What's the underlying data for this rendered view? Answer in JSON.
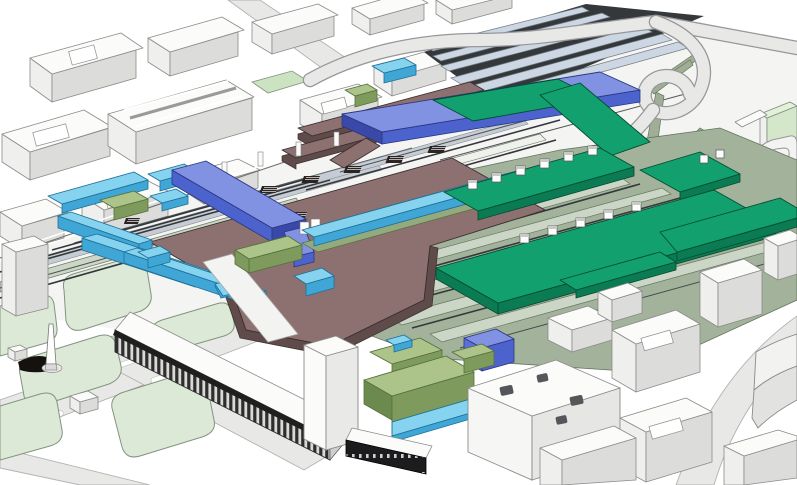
{
  "scene": {
    "kind": "3d-axonometric-railway-station-masterplan",
    "elements": [
      {
        "name": "context-city-blocks",
        "color_key": "block_top"
      },
      {
        "name": "railway-tracks",
        "color_key": "track_dark"
      },
      {
        "name": "north-platforms",
        "color_key": "platform_pale"
      },
      {
        "name": "south-platform-yard",
        "color_key": "platform_sage"
      },
      {
        "name": "concourse-deck",
        "color_key": "mauve_top"
      },
      {
        "name": "green-roof-deck",
        "color_key": "emerald_top"
      },
      {
        "name": "pedestrian-bridges",
        "color_key": "blue_top"
      },
      {
        "name": "secondary-walkways",
        "color_key": "cyan_top"
      },
      {
        "name": "pavilion-buildings",
        "color_key": "olive_top"
      },
      {
        "name": "historic-station-building",
        "color_key": "block_top"
      },
      {
        "name": "park",
        "color_key": "lawn"
      },
      {
        "name": "elevated-road",
        "color_key": "road_fill"
      }
    ]
  },
  "palette": {
    "paper": "#ffffff",
    "corridor": "#f4f4f3",
    "road_fill": "#e8e8e7",
    "road_edge": "#b2b2b0",
    "block_top": "#fbfbfa",
    "block_side_light": "#efefed",
    "block_side_dark": "#dcdcda",
    "block_stroke": "#8b8b89",
    "lawn": "#dce9d7",
    "lawn_stroke": "#83937f",
    "green_field": "#cbe3c0",
    "track_dark": "#34383b",
    "platform_pale": "#ccd7e3",
    "plat_stroke": "#707a84",
    "platform_sage": "#a2b29b",
    "platform_sage_light": "#cbd6c6",
    "sage_stroke": "#66755f",
    "wedge": "#9fae95",
    "emerald_top": "#12a16e",
    "emerald_side": "#0a7b52",
    "emerald_stroke": "#064a31",
    "blue_top": "#8292e3",
    "blue_side": "#4c63ce",
    "blue_deep": "#3a49a8",
    "blue_dark": "#2b3780",
    "cyan_top": "#85d3ef",
    "cyan_side": "#3fa6d6",
    "cyan_dark": "#1f6f96",
    "olive_top": "#acc389",
    "olive_side": "#7e9b5d",
    "olive_dark": "#55703b",
    "mauve_top": "#8c7170",
    "mauve_side": "#5f4c4a",
    "mauve_stroke": "#3a2e2d",
    "dark_base": "#1c1c1e",
    "shadow_dark": "#14110e"
  }
}
